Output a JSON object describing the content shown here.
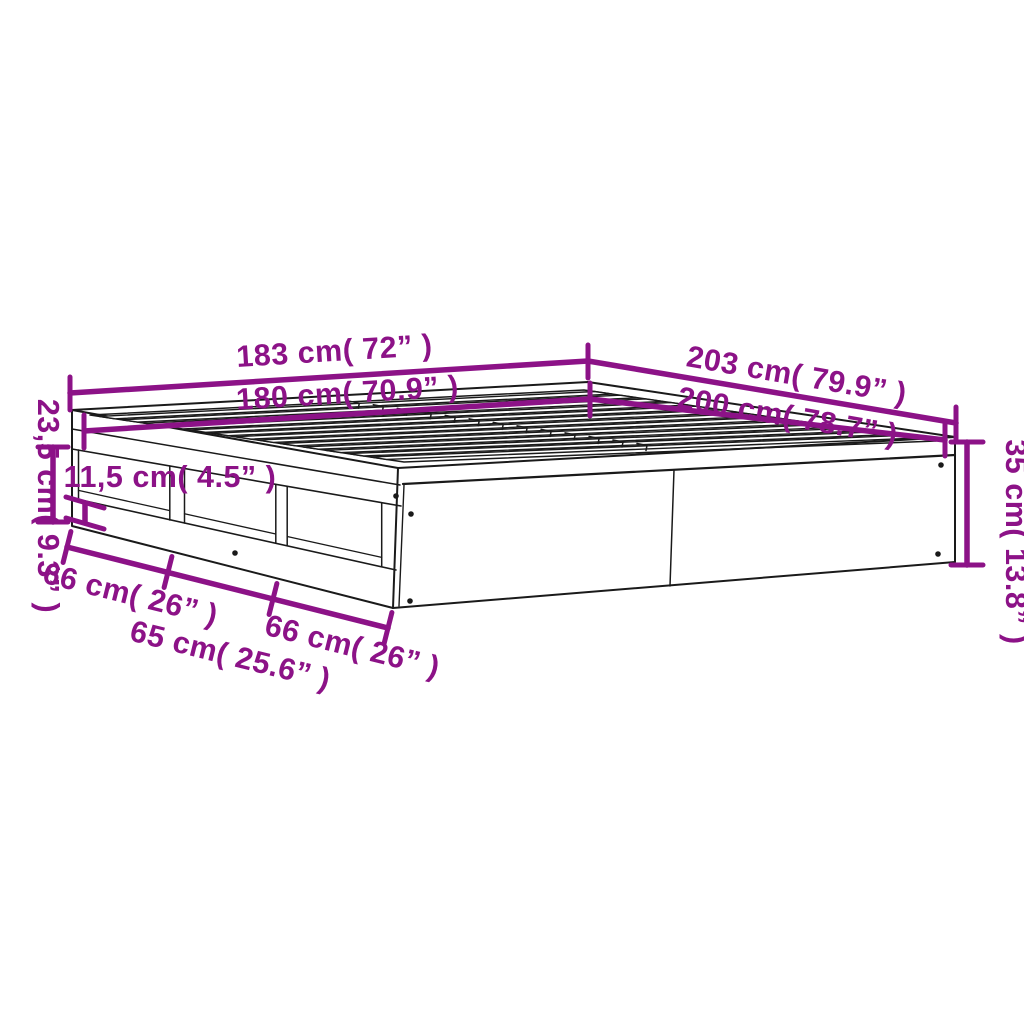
{
  "diagram": {
    "kind": "product-dimension-diagram",
    "subject": "bed-frame-with-open-storage-compartments",
    "colors": {
      "accent": "#8C1287",
      "line": "#1a1a1a",
      "background": "#ffffff"
    },
    "labels": {
      "width_outer": "183 cm( 72” )",
      "width_inner": "180 cm( 70.9” )",
      "length_outer": "203 cm( 79.9” )",
      "length_inner": "200 cm( 78.7” )",
      "side_height": "23,5 cm( 9.3” )",
      "base_height": "11,5 cm( 4.5” )",
      "frame_height": "35 cm( 13.8” )",
      "compartment_1": "66 cm( 26” )",
      "compartment_2": "65 cm( 25.6” )",
      "compartment_3": "66 cm( 26” )"
    }
  }
}
